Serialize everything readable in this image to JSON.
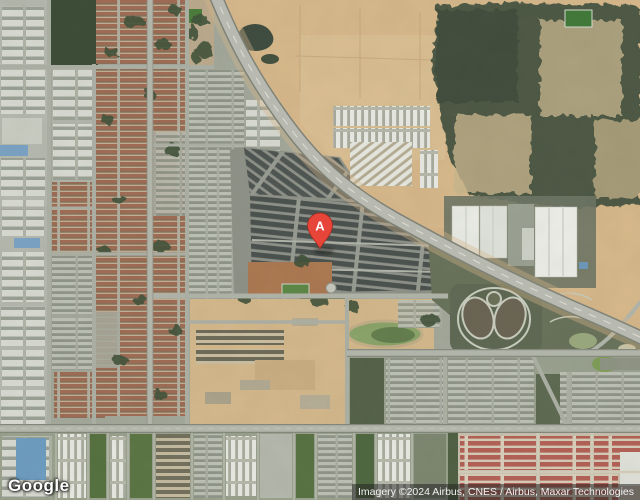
{
  "map": {
    "view_type": "satellite",
    "marker": {
      "label": "A",
      "color": "#E8453A",
      "outline": "#9E2B1E"
    },
    "features": [
      "curved highway from top-center to right edge",
      "residential rooftop grids west",
      "industrial warehouses",
      "bare earth fields northeast",
      "scrubland northeast",
      "parking rows compound at marker",
      "loop-shaped park southeast",
      "terraced housing rows south"
    ]
  },
  "branding": {
    "logo_text": "Google"
  },
  "attribution": {
    "text": "Imagery ©2024 Airbus, CNES / Airbus, Maxar Technologies"
  },
  "palette": {
    "earth_tan": "#d6b78a",
    "scrub_dark": "#4d5845",
    "roof_red": "#9f6b54",
    "roof_gray": "#bcbfb4",
    "road_gray": "#b7b9b0",
    "vegetation": "#42523a",
    "pond_green": "#7f9e58",
    "marker_red": "#E8453A"
  }
}
